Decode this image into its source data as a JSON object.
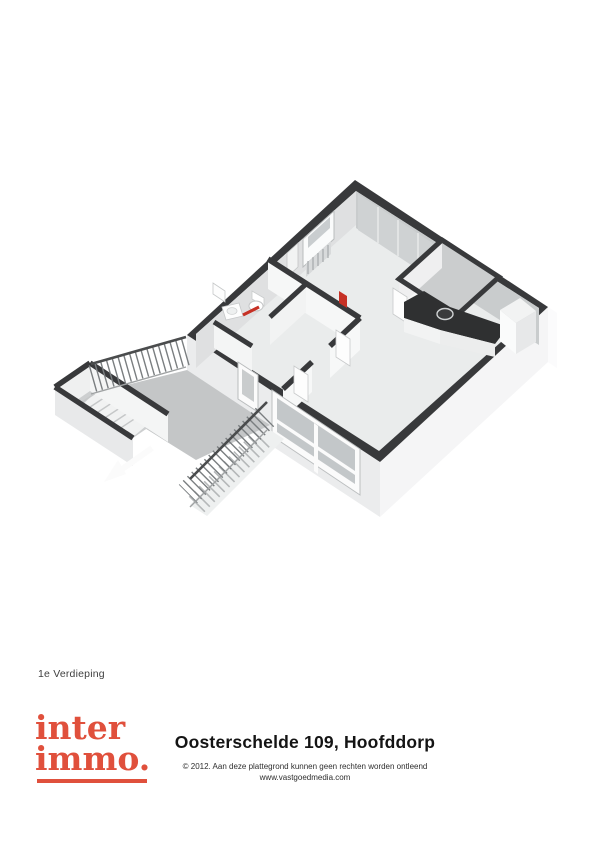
{
  "page": {
    "background": "#ffffff"
  },
  "floor_label": "1e Verdieping",
  "footer": {
    "logo": {
      "line1": "inter",
      "line2": "immo.",
      "color": "#e0503c",
      "underline": true
    },
    "title": "Oosterschelde 109, Hoofddorp",
    "copyright_line1": "© 2012. Aan deze plattegrond kunnen geen rechten worden ontleend",
    "copyright_line2": "www.vastgoedmedia.com"
  },
  "floorplan": {
    "view": "3d-isometric-floorplan-render",
    "palette": {
      "wall_cap": "#38393b",
      "exterior_wall": "#f3f3f4",
      "interior_floor": "#eaecec",
      "interior_wall_face": "#f6f7f7",
      "gallery_floor": "#c4c6c7",
      "glass": "#c3c7c9",
      "kitchen_counter": "#2f3031",
      "accent_red": "#c63125"
    },
    "elements": [
      "apartment-shell",
      "bedroom-window-with-radiator",
      "wardrobe-panels",
      "bathroom-toilet",
      "bathroom-washbasin",
      "bathroom-towel-radiator",
      "bathroom-mirror",
      "hall-red-radiator",
      "storage-room",
      "kitchen-counter-with-sink",
      "kitchen-tall-cabinet",
      "entrance-door",
      "living-room-window",
      "gallery-walkway",
      "gallery-railing",
      "stairwell-enclosure",
      "staircase",
      "stair-direction-arrow"
    ]
  }
}
